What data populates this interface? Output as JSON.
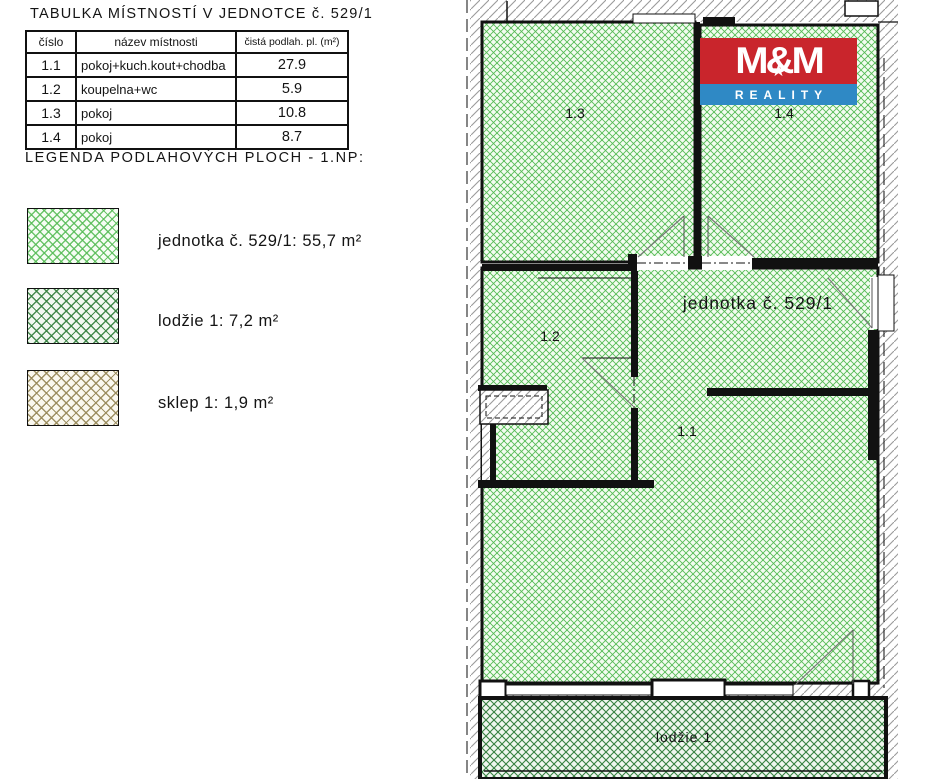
{
  "table": {
    "title": "TABULKA MÍSTNOSTÍ V JEDNOTCE č. 529/1",
    "headers": {
      "cislo": "číslo",
      "nazev": "název místnosti",
      "plocha": "čistá podlah. pl. (m²)"
    },
    "rows": [
      {
        "cislo": "1.1",
        "nazev": "pokoj+kuch.kout+chodba",
        "plocha": "27.9"
      },
      {
        "cislo": "1.2",
        "nazev": "koupelna+wc",
        "plocha": "5.9"
      },
      {
        "cislo": "1.3",
        "nazev": "pokoj",
        "plocha": "10.8"
      },
      {
        "cislo": "1.4",
        "nazev": "pokoj",
        "plocha": "8.7"
      }
    ]
  },
  "legend": {
    "title": "LEGENDA PODLAHOVÝCH PLOCH - 1.NP:",
    "items": [
      {
        "label": "jednotka č. 529/1: 55,7 m²",
        "hatch_color": "#55bb55"
      },
      {
        "label": "lodžie 1: 7,2 m²",
        "hatch_color": "#35803f"
      },
      {
        "label": "sklep 1: 1,9 m²",
        "hatch_color": "#968757"
      }
    ]
  },
  "plan": {
    "unit_label": "jednotka č. 529/1",
    "room_labels": {
      "r11": "1.1",
      "r12": "1.2",
      "r13": "1.3",
      "r14": "1.4"
    },
    "balcony_label": "lodžie 1",
    "logo": {
      "title": "M&M",
      "subtitle": "REALITY",
      "red": "#c9252c",
      "blue": "#2f89c5"
    },
    "colors": {
      "unit_hatch": "#55bb55",
      "balcony_hatch": "#35803f",
      "wall_hatch": "#9b9b9b"
    }
  }
}
